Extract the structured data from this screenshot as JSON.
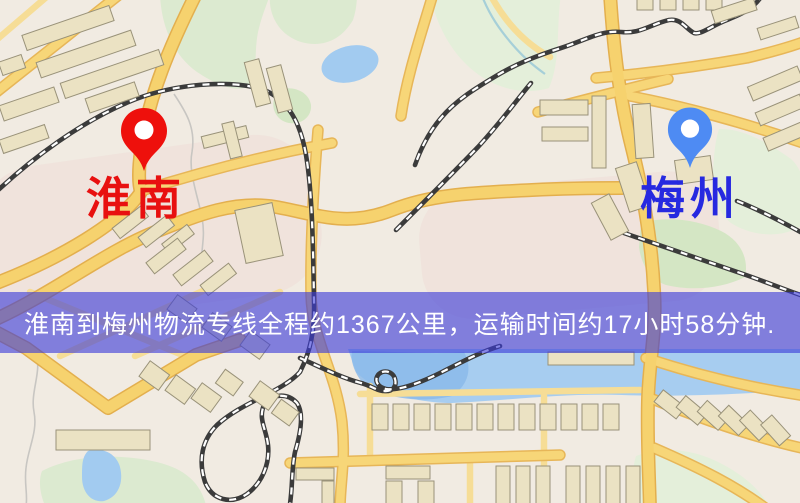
{
  "origin": {
    "label": "淮南",
    "icon": "map-pin-icon"
  },
  "destination": {
    "label": "梅州",
    "icon": "map-pin-icon"
  },
  "banner": {
    "text": "淮南到梅州物流专线全程约1367公里，运输时间约17小时58分钟."
  },
  "colors": {
    "origin_pin": "#ee100c",
    "origin_label": "#e81010",
    "destination_pin": "#4e8bf3",
    "destination_label": "#2629e0",
    "banner_bg": "rgba(60,60,216,0.62)",
    "banner_text": "#ffffff"
  }
}
